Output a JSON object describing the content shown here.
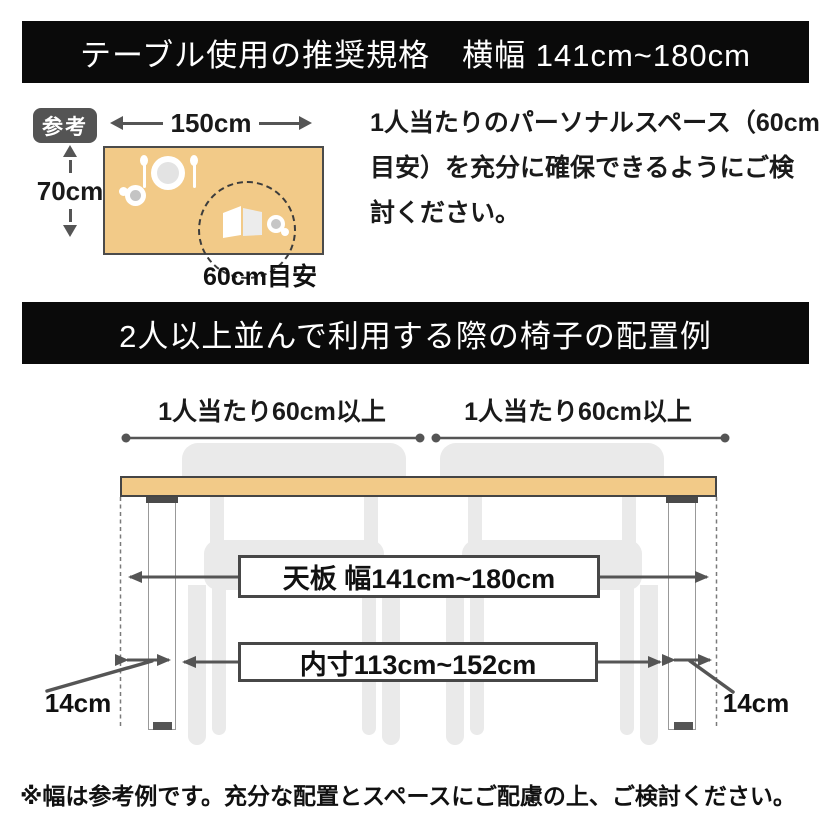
{
  "colors": {
    "banner_bg": "#0a0a0a",
    "banner_text": "#ffffff",
    "tabletop": "#f2ca88",
    "dimension_line": "#555555",
    "chair_silhouette": "#eaeaea",
    "badge_bg": "#545454"
  },
  "header_top": {
    "title": "テーブル使用の推奨規格　横幅 141cm~180cm"
  },
  "reference_section": {
    "badge_label": "参考",
    "table_width_label": "150cm",
    "table_depth_label": "70cm",
    "personal_space_label": "60cm目安",
    "note_lines": [
      "1人当たりのパーソナルスペース（60cm",
      "目安）を充分に確保できるようにご検",
      "討ください。"
    ],
    "icons": [
      "plate-icon",
      "fork-icon",
      "spoon-icon",
      "cup-icon",
      "open-book-icon",
      "teacup-icon",
      "personal-space-dashed-circle"
    ]
  },
  "header_bottom": {
    "title": "2人以上並んで利用する際の椅子の配置例"
  },
  "layout_diagram": {
    "per_person_left": "1人当たり60cm以上",
    "per_person_right": "1人当たり60cm以上",
    "tabletop_width_label": "天板 幅141cm~180cm",
    "inner_width_label": "内寸113cm~152cm",
    "leg_offset_left": "14cm",
    "leg_offset_right": "14cm"
  },
  "footer": {
    "note": "※幅は参考例です。充分な配置とスペースにご配慮の上、ご検討ください。"
  }
}
